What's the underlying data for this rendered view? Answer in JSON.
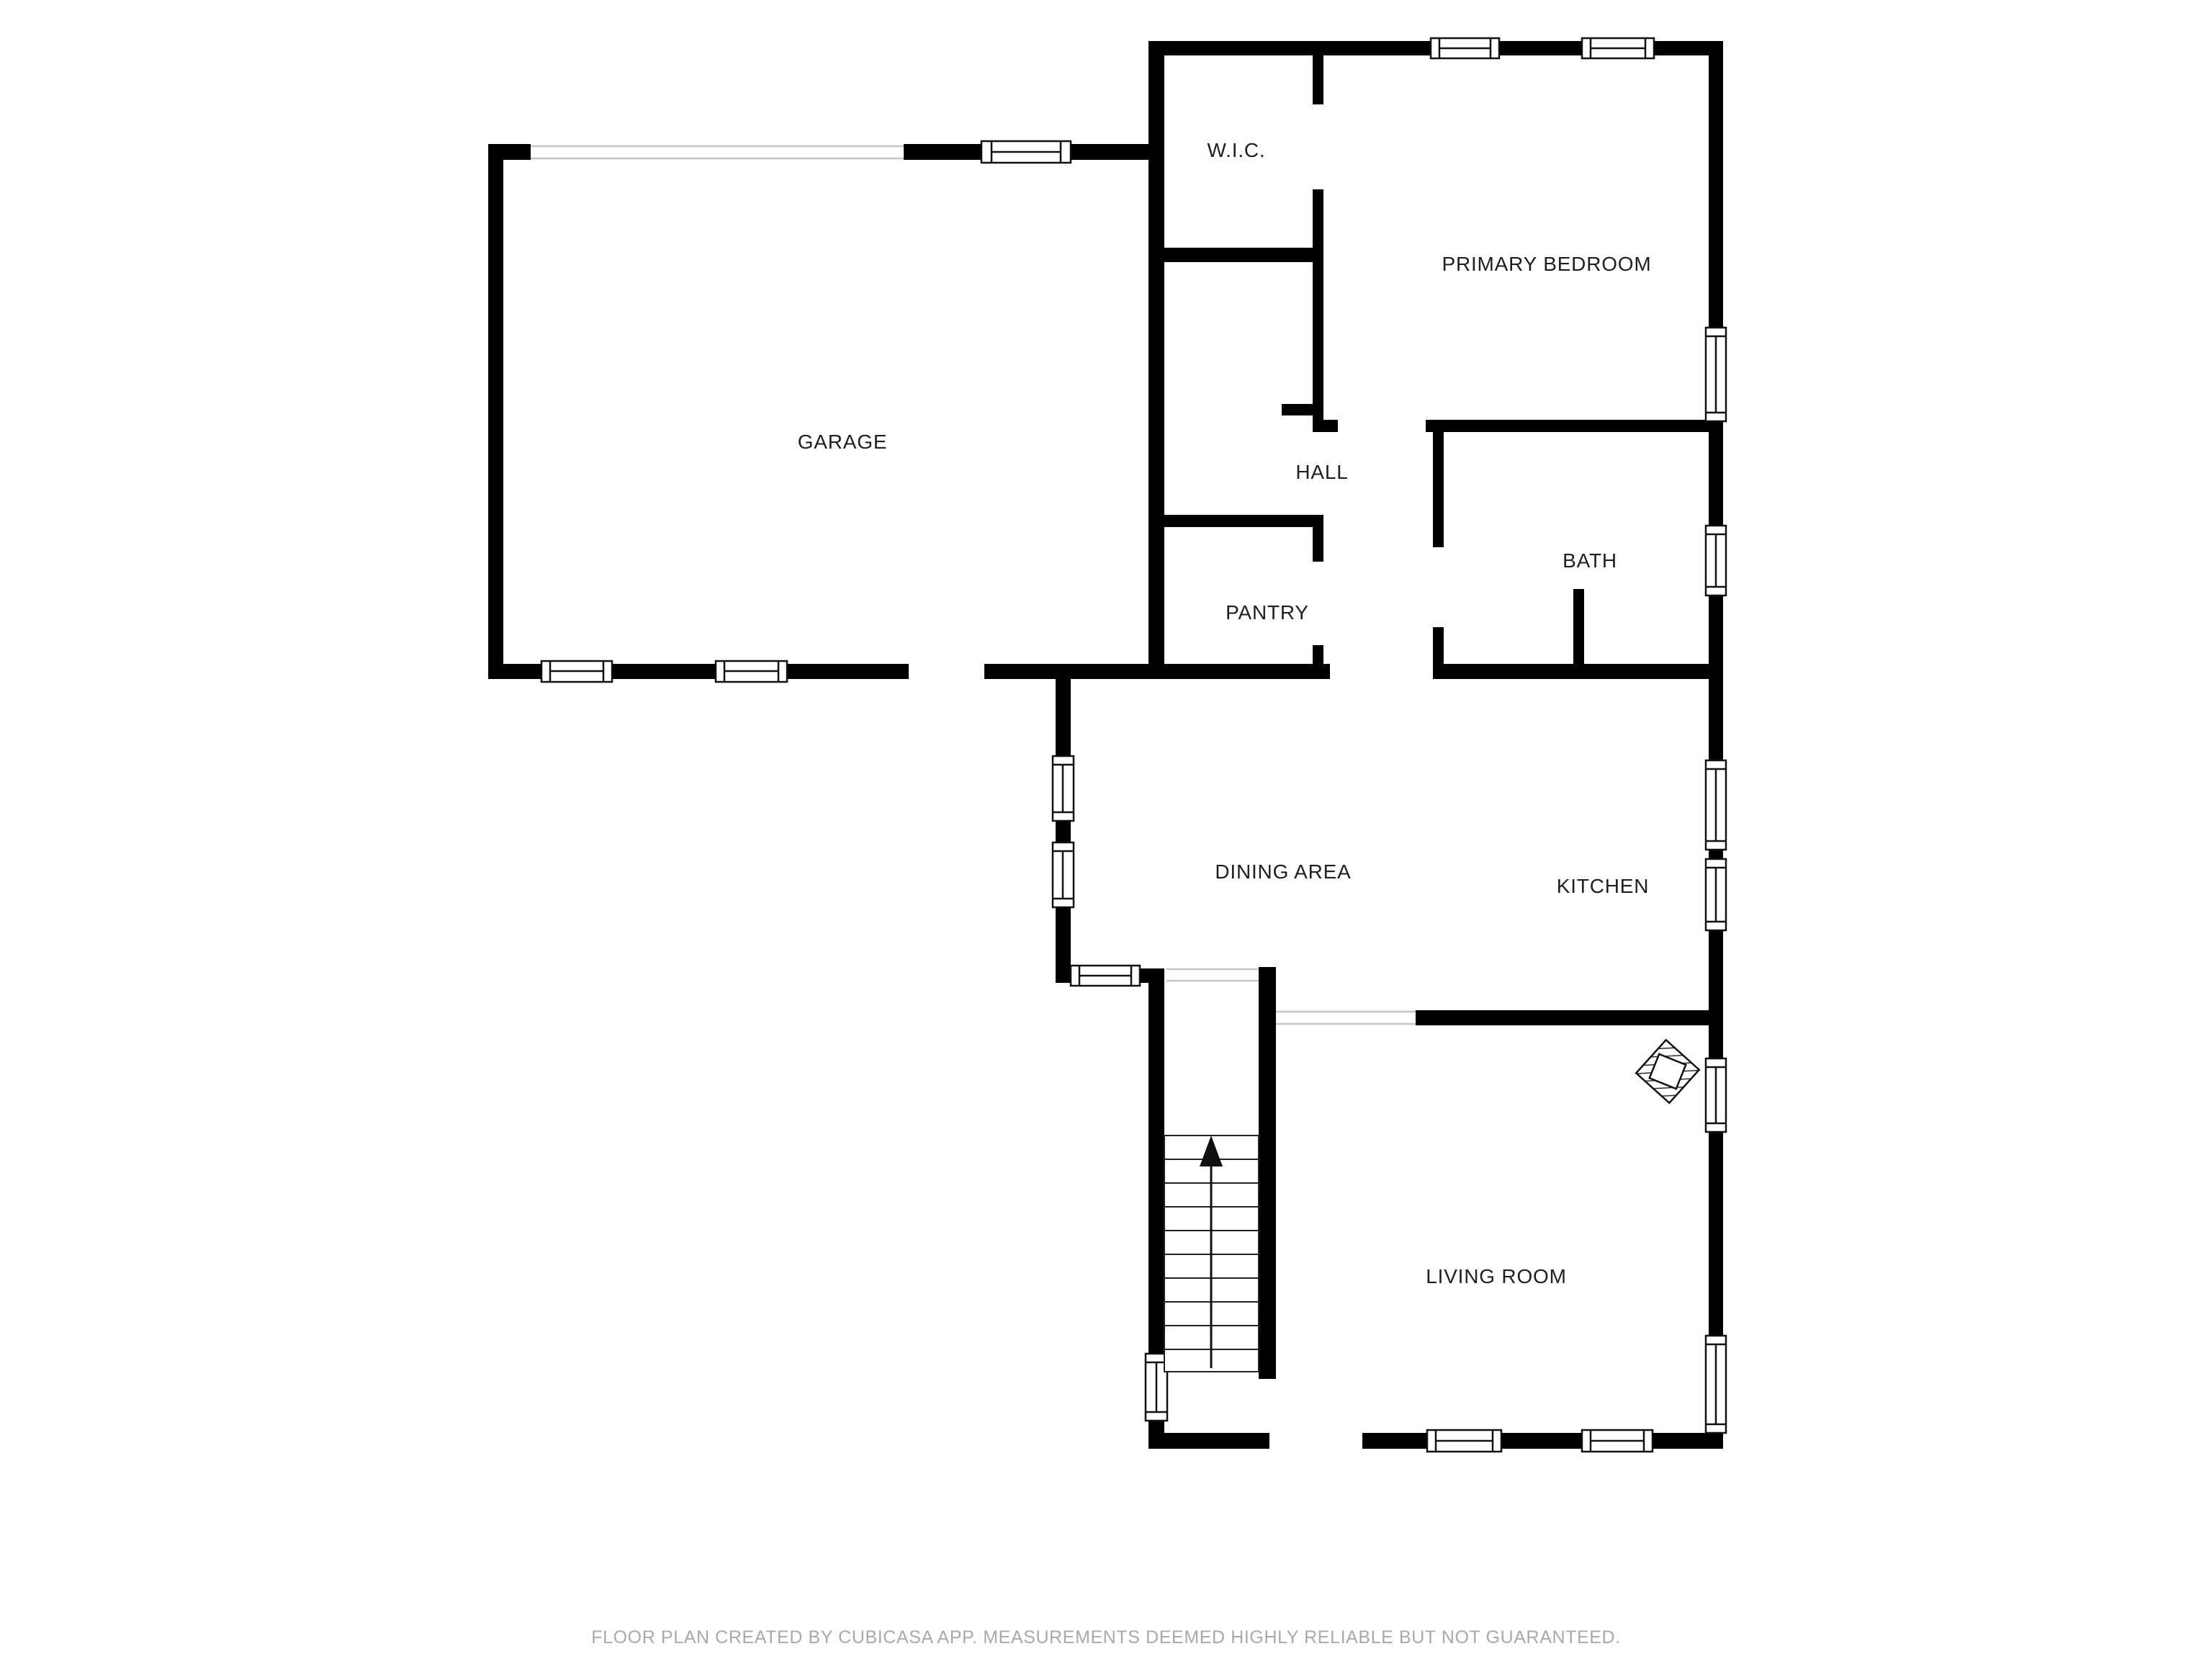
{
  "rooms": {
    "garage": "GARAGE",
    "wic": "W.I.C.",
    "primary_bedroom": "PRIMARY BEDROOM",
    "hall": "HALL",
    "pantry": "PANTRY",
    "bath": "BATH",
    "dining": "DINING AREA",
    "kitchen": "KITCHEN",
    "living": "LIVING ROOM"
  },
  "footer": {
    "text": "FLOOR PLAN CREATED BY CUBICASA APP. MEASUREMENTS DEEMED HIGHLY RELIABLE BUT NOT GUARANTEED."
  },
  "colors": {
    "wall": "#000000",
    "background": "#ffffff",
    "label_text": "#1f1f1f",
    "footer_text": "#a9a9a9",
    "opening_line": "#c6c6c6"
  },
  "icons": {
    "stairs_up_arrow": "up-arrow",
    "fireplace": "hatched-diamond"
  }
}
